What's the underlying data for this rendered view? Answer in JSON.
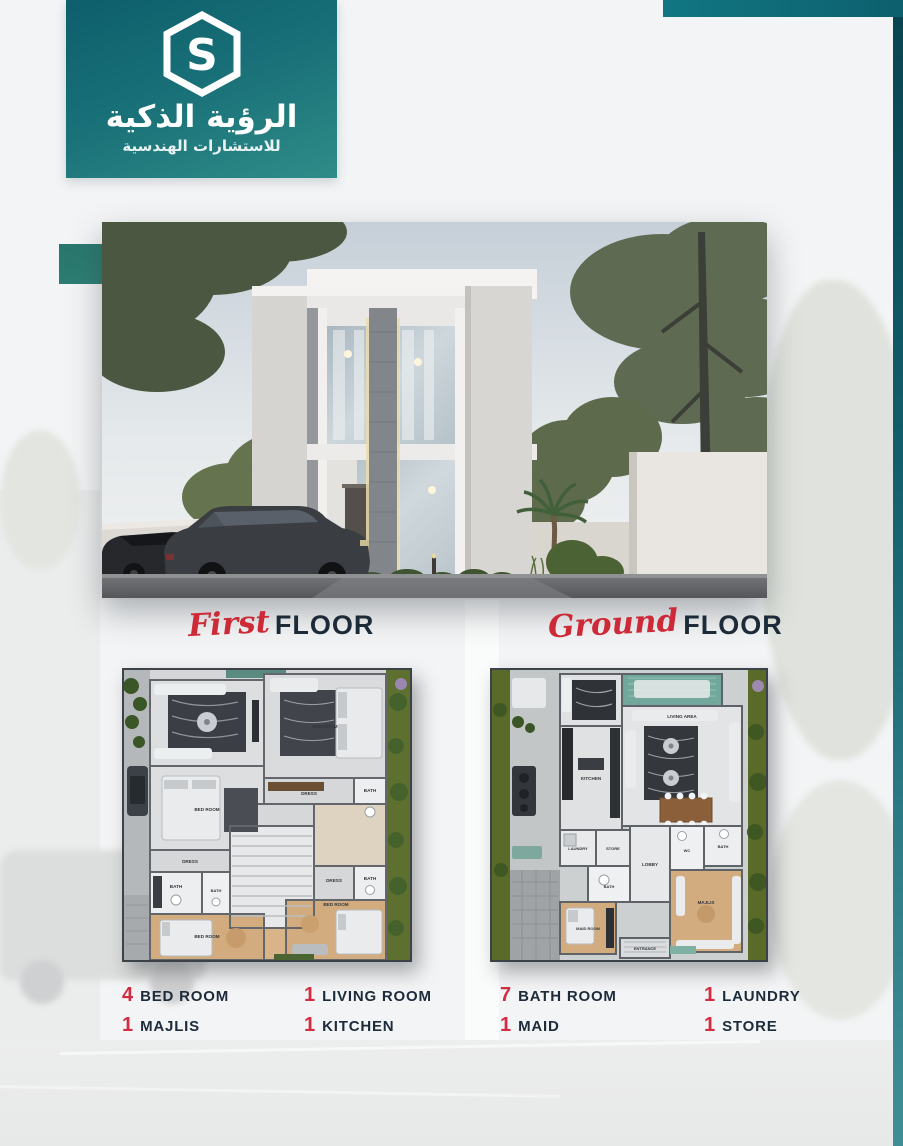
{
  "brand": {
    "name_arabic": "الرؤية الذكية",
    "tagline_arabic": "للاستشارات الهندسية",
    "logo_icon": "hexagon-s-monogram",
    "colors": {
      "teal": "#147079",
      "teal_dark": "#0c4a56",
      "red": "#ce2d3c",
      "navy": "#1d2b3a"
    }
  },
  "sections": {
    "first_floor": {
      "script_word": "First",
      "block_word": "FLOOR"
    },
    "ground_floor": {
      "script_word": "Ground",
      "block_word": "FLOOR"
    }
  },
  "features": [
    {
      "count": "4",
      "label": "BED ROOM"
    },
    {
      "count": "1",
      "label": "MAJLIS"
    },
    {
      "count": "1",
      "label": "LIVING ROOM"
    },
    {
      "count": "1",
      "label": "KITCHEN"
    },
    {
      "count": "7",
      "label": "BATH ROOM"
    },
    {
      "count": "1",
      "label": "MAID"
    },
    {
      "count": "1",
      "label": "LAUNDRY"
    },
    {
      "count": "1",
      "label": "STORE"
    }
  ],
  "plans": {
    "first": {
      "rooms": [
        "BED ROOM",
        "DRESS",
        "BATH",
        "BED ROOM",
        "DRESS",
        "BATH",
        "BATH",
        "DRESS",
        "BATH",
        "BED ROOM",
        "BED ROOM"
      ]
    },
    "ground": {
      "rooms": [
        "LIVING AREA",
        "KITCHEN",
        "LAUNDRY",
        "STORE",
        "BATH",
        "LOBBY",
        "WC",
        "BATH",
        "MAJLIS",
        "MAID ROOM",
        "ENTRANCE",
        "BARBECUE AREA"
      ]
    }
  }
}
